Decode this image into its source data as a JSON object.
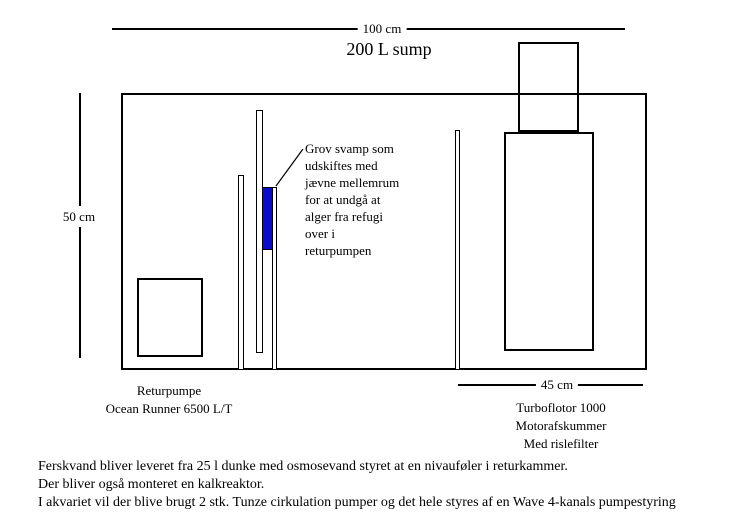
{
  "title": "200 L sump",
  "dimensions": {
    "top": "100 cm",
    "left": "50 cm",
    "bottom_right": "45 cm"
  },
  "annotation": {
    "lines": [
      "Grov svamp som",
      "udskiftes med",
      "jævne mellemrum",
      "for at undgå at",
      "alger fra refugi",
      "over i",
      "returpumpen"
    ]
  },
  "labels": {
    "return_pump": [
      "Returpumpe",
      "Ocean Runner 6500 L/T"
    ],
    "skimmer": [
      "Turboflotor 1000",
      "Motorafskummer",
      "Med rislefilter"
    ]
  },
  "notes": [
    "Ferskvand bliver leveret fra 25 l dunke med osmosevand styret at en nivauføler i returkammer.",
    "Der bliver også monteret en kalkreaktor.",
    "I akvariet vil der blive brugt 2 stk. Tunze cirkulation pumper og det hele styres af en Wave 4-kanals pumpestyring"
  ],
  "colors": {
    "line": "#000000",
    "sponge": "#0b0bd0",
    "background": "#ffffff"
  }
}
